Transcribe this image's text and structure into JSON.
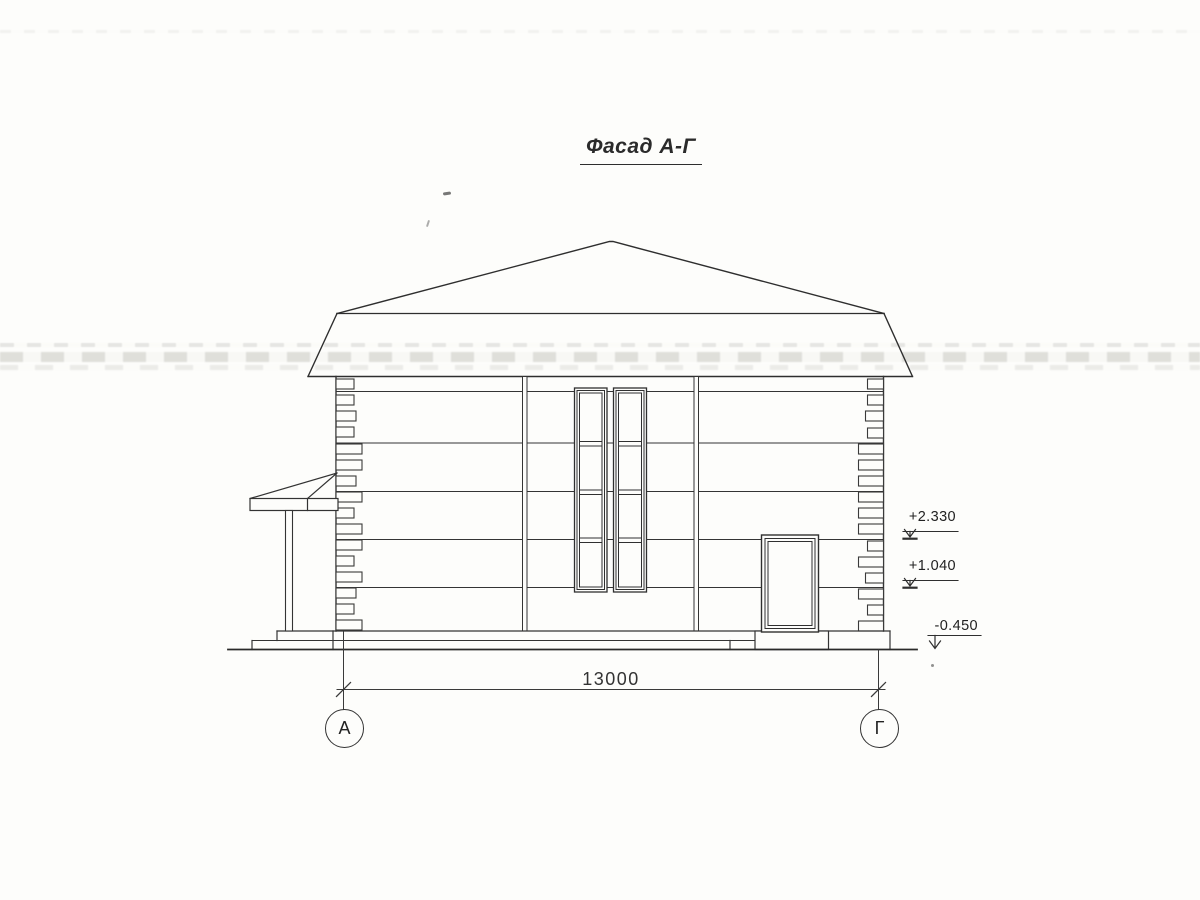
{
  "drawing": {
    "title": "Фасад А-Г",
    "dimension_total": "13000",
    "elevation_marks": [
      "+2.330",
      "+1.040",
      "-0.450"
    ],
    "axis_labels": [
      "А",
      "Г"
    ]
  }
}
